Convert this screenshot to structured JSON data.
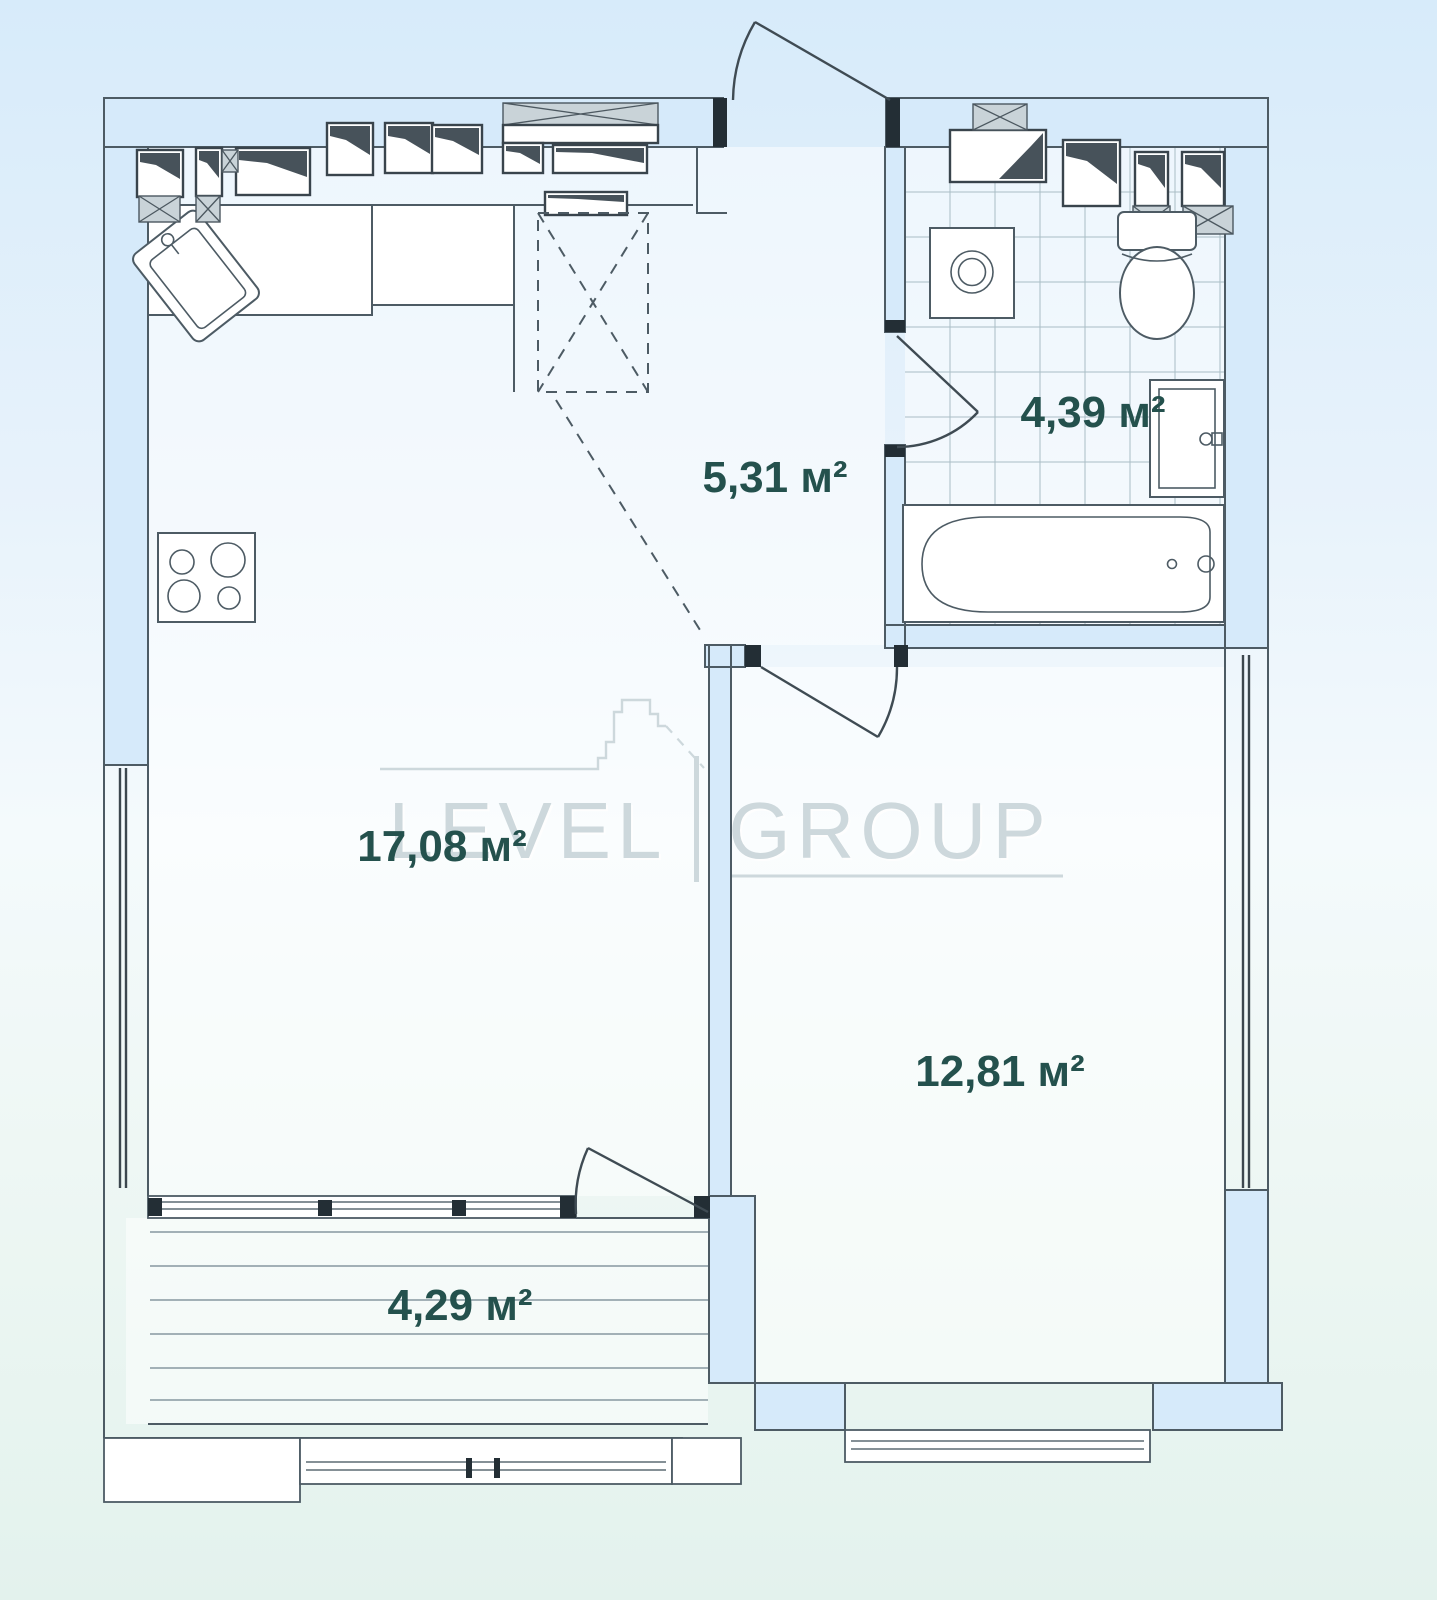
{
  "watermark": {
    "left": "LEVEL",
    "right": "GROUP"
  },
  "rooms": {
    "kitchen_living": {
      "area": "17,08 м²"
    },
    "hallway": {
      "area": "5,31 м²"
    },
    "bathroom": {
      "area": "4,39 м²"
    },
    "bedroom": {
      "area": "12,81 м²"
    },
    "balcony": {
      "area": "4,29 м²"
    }
  },
  "colors": {
    "bg_top": "#d7ebfa",
    "bg_bottom": "#e3f2ed",
    "wall_fill": "#d6eafa",
    "line": "#4d5b64",
    "label_text": "#24514d",
    "watermark": "#cdd8dc"
  }
}
